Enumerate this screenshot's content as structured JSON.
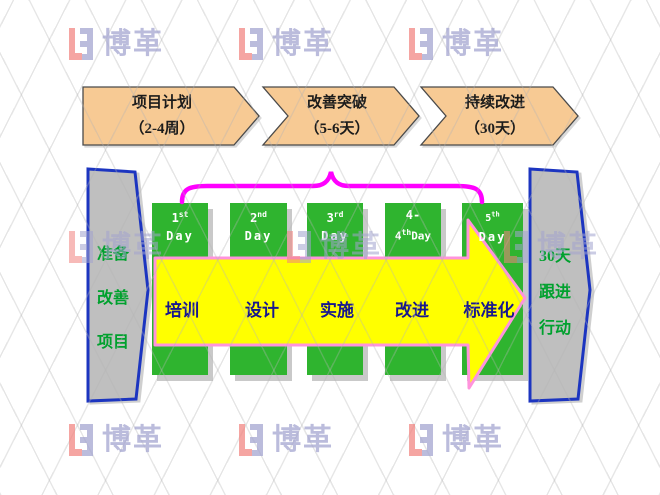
{
  "slide": {
    "phases": [
      {
        "title": "项目计划",
        "duration": "（2-4周）"
      },
      {
        "title": "改善突破",
        "duration": "（5-6天）"
      },
      {
        "title": "持续改进",
        "duration": "（30天）"
      }
    ],
    "left_banner": {
      "lines": [
        "准备",
        "改善",
        "项目"
      ]
    },
    "right_banner": {
      "lines": [
        "30天",
        "跟进",
        "行动"
      ]
    },
    "days": [
      {
        "l1a": "1",
        "l1sup": "st",
        "l1b": "",
        "l2a": "Day",
        "l2sup": "",
        "l2b": ""
      },
      {
        "l1a": "2",
        "l1sup": "nd",
        "l1b": "",
        "l2a": "Day",
        "l2sup": "",
        "l2b": ""
      },
      {
        "l1a": "3",
        "l1sup": "rd",
        "l1b": "",
        "l2a": "Day",
        "l2sup": "",
        "l2b": ""
      },
      {
        "l1a": "4-",
        "l1sup": "",
        "l1b": "",
        "l2a": "4",
        "l2sup": "th",
        "l2b": "Day"
      },
      {
        "l1a": "5",
        "l1sup": "th",
        "l1b": "",
        "l2a": "Day",
        "l2sup": "",
        "l2b": ""
      }
    ],
    "steps": [
      "培训",
      "设计",
      "实施",
      "改进",
      "标准化"
    ],
    "watermark": {
      "brand": "博革"
    },
    "colors": {
      "chevron_fill": "#F7CA94",
      "box_green": "#2FB42F",
      "arrow_yellow": "#FFFF00",
      "arrow_border_pink": "#FF93DC",
      "brace_magenta": "#FF00FF",
      "banner_gray": "#BFBFBF",
      "banner_border_blue": "#1C35C0",
      "banner_text_green": "#00A12E",
      "step_text_navy": "#17178F",
      "watermark_lavender": "#A2A3CF",
      "watermark_red": "#F2837F"
    }
  }
}
